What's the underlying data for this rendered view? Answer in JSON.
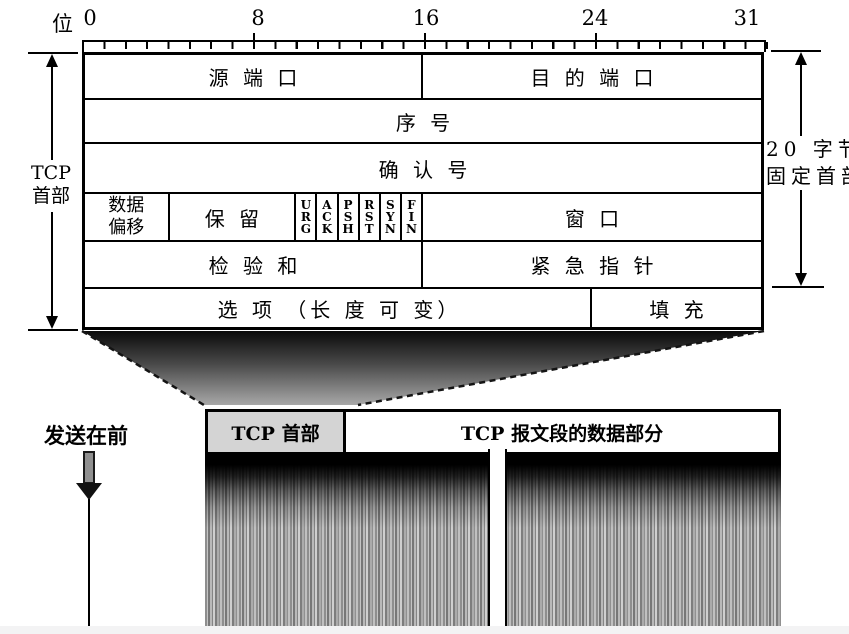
{
  "ruler": {
    "bit_unit_label": "位",
    "tick_labels": [
      "0",
      "8",
      "16",
      "24",
      "31"
    ]
  },
  "tcp_header_table": {
    "source_port": "源 端 口",
    "destination_port": "目 的 端 口",
    "sequence_number": "序 号",
    "acknowledgment_number": "确 认 号",
    "data_offset": "数据\n偏移",
    "reserved": "保 留",
    "flags": [
      "U\nR\nG",
      "A\nC\nK",
      "P\nS\nH",
      "R\nS\nT",
      "S\nY\nN",
      "F\nI\nN"
    ],
    "window": "窗 口",
    "checksum": "检 验 和",
    "urgent_pointer": "紧 急 指 针",
    "options": "选 项 （长 度 可 变）",
    "padding": "填 充"
  },
  "left_dimension_label": "TCP\n首部",
  "right_dimension_label": "20 字节的\n固定首部",
  "send_direction_label": "发送在前",
  "segment_bar": {
    "header_label": "TCP 首部",
    "data_label": "TCP 报文段的数据部分"
  },
  "colors": {
    "ink": "#000000",
    "header_box_fill": "#d4d4d4",
    "funnel_top": "#0a0a0a",
    "funnel_bottom": "#a8a8a8"
  }
}
